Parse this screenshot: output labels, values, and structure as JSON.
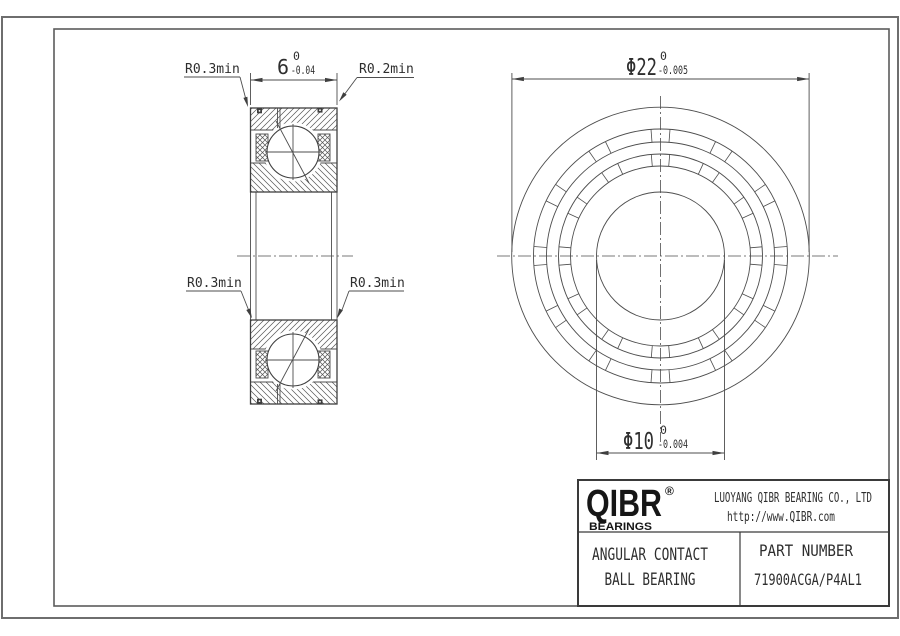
{
  "drawing": {
    "section_view": {
      "label_top_left": "R0.3min",
      "label_top_right": "R0.2min",
      "label_bottom_left": "R0.3min",
      "label_bottom_right": "R0.3min",
      "width_dim": {
        "value": "6",
        "tol_upper": "0",
        "tol_lower": "-0.04"
      }
    },
    "front_view": {
      "outer_dia": {
        "value": "Φ22",
        "tol_upper": "0",
        "tol_lower": "-0.005"
      },
      "bore_dia": {
        "value": "Φ10",
        "tol_upper": "0",
        "tol_lower": "-0.004"
      }
    },
    "title_block": {
      "logo": "QIBR",
      "logo_reg": "®",
      "logo_sub": "BEARINGS",
      "company": "LUOYANG QIBR BEARING CO., LTD",
      "website": "http://www.QIBR.com",
      "product_line1": "ANGULAR CONTACT",
      "product_line2": "BALL BEARING",
      "part_label": "PART NUMBER",
      "part_number": "71900ACGA/P4AL1"
    },
    "colors": {
      "line": "#4d4d4d",
      "border": "#6e6e6e",
      "background": "#ffffff"
    }
  }
}
